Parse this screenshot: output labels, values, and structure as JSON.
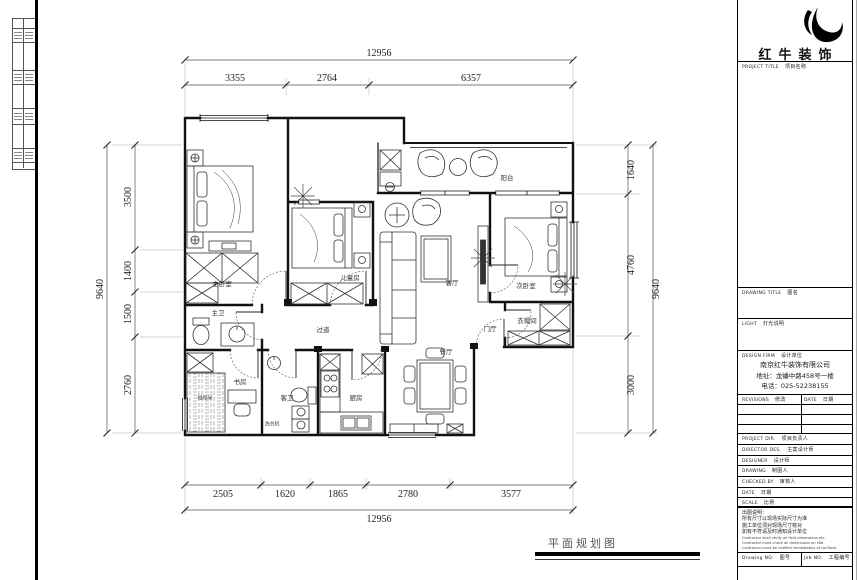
{
  "sheet": {
    "footer": {
      "drawing_name": "平面规划图"
    }
  },
  "title_block": {
    "brand_name": "红牛装饰",
    "project_title": {
      "en": "PROJECT TITLE",
      "cn": "项目名称"
    },
    "drawing_title": {
      "en": "DRAWING TITLE",
      "cn": "图名"
    },
    "light": {
      "en": "LIGHT",
      "cn": "灯光说明"
    },
    "design_firm": {
      "en": "DESIGN FIRM",
      "cn": "设计单位"
    },
    "firm_info": [
      "南京红牛装饰有限公司",
      "地址：龙蟠中路458号一楼",
      "电话：025-52238155"
    ],
    "revisions": {
      "en": "REVISIONS",
      "cn": "修改"
    },
    "date_col": {
      "en": "DATE",
      "cn": "日期"
    },
    "rows": [
      {
        "en": "PROJECT DIR.",
        "cn": "项目负责人"
      },
      {
        "en": "DIRECTOR DES.",
        "cn": "主案设计师"
      },
      {
        "en": "DESIGNER",
        "cn": "设计师"
      },
      {
        "en": "DRAWING",
        "cn": "制图人"
      },
      {
        "en": "CHECKED BY",
        "cn": "审核人"
      },
      {
        "en": "DATE",
        "cn": "日期"
      },
      {
        "en": "SCALE",
        "cn": "比例"
      }
    ],
    "notes_cn": [
      "出图说明：",
      "所有尺寸以现场实际尺寸为准",
      "施工单位须对现场尺寸核对",
      "如有不符请及时通知设计单位"
    ],
    "notes_en": [
      "Contractor shall verify all field dimensions etc.",
      "Contractor must check all dimensions on site.",
      "Contractor must be notified immediately of conflicts."
    ],
    "drawing_no": {
      "en": "Drawing NO.",
      "cn": "图号"
    },
    "job_no": {
      "en": "Job NO.",
      "cn": "工程编号"
    }
  },
  "plan": {
    "dimensions": {
      "top": {
        "total": "12956",
        "segments": [
          "3355",
          "2764",
          "6357"
        ]
      },
      "bottom": {
        "total": "12956",
        "segments": [
          "2505",
          "1620",
          "1865",
          "2780",
          "3577"
        ]
      },
      "left": {
        "total": "9640",
        "segments": [
          "3500",
          "1400",
          "1500",
          "2760"
        ]
      },
      "right": {
        "total": "9640",
        "segments": [
          "1640",
          "4760",
          "3000"
        ]
      }
    },
    "rooms": {
      "master_bedroom": "主卧室",
      "kids_room": "儿童房",
      "living_room": "客厅",
      "balcony": "阳台",
      "second_bedroom": "次卧室",
      "cloakroom": "衣帽间",
      "entry_hall": "门厅",
      "corridor": "过道",
      "dining_room": "餐厅",
      "kitchen": "厨房",
      "master_bath": "主卫",
      "guest_bath": "客卫",
      "study": "书房",
      "tatami": "榻榻米",
      "washer": "洗衣机"
    }
  }
}
